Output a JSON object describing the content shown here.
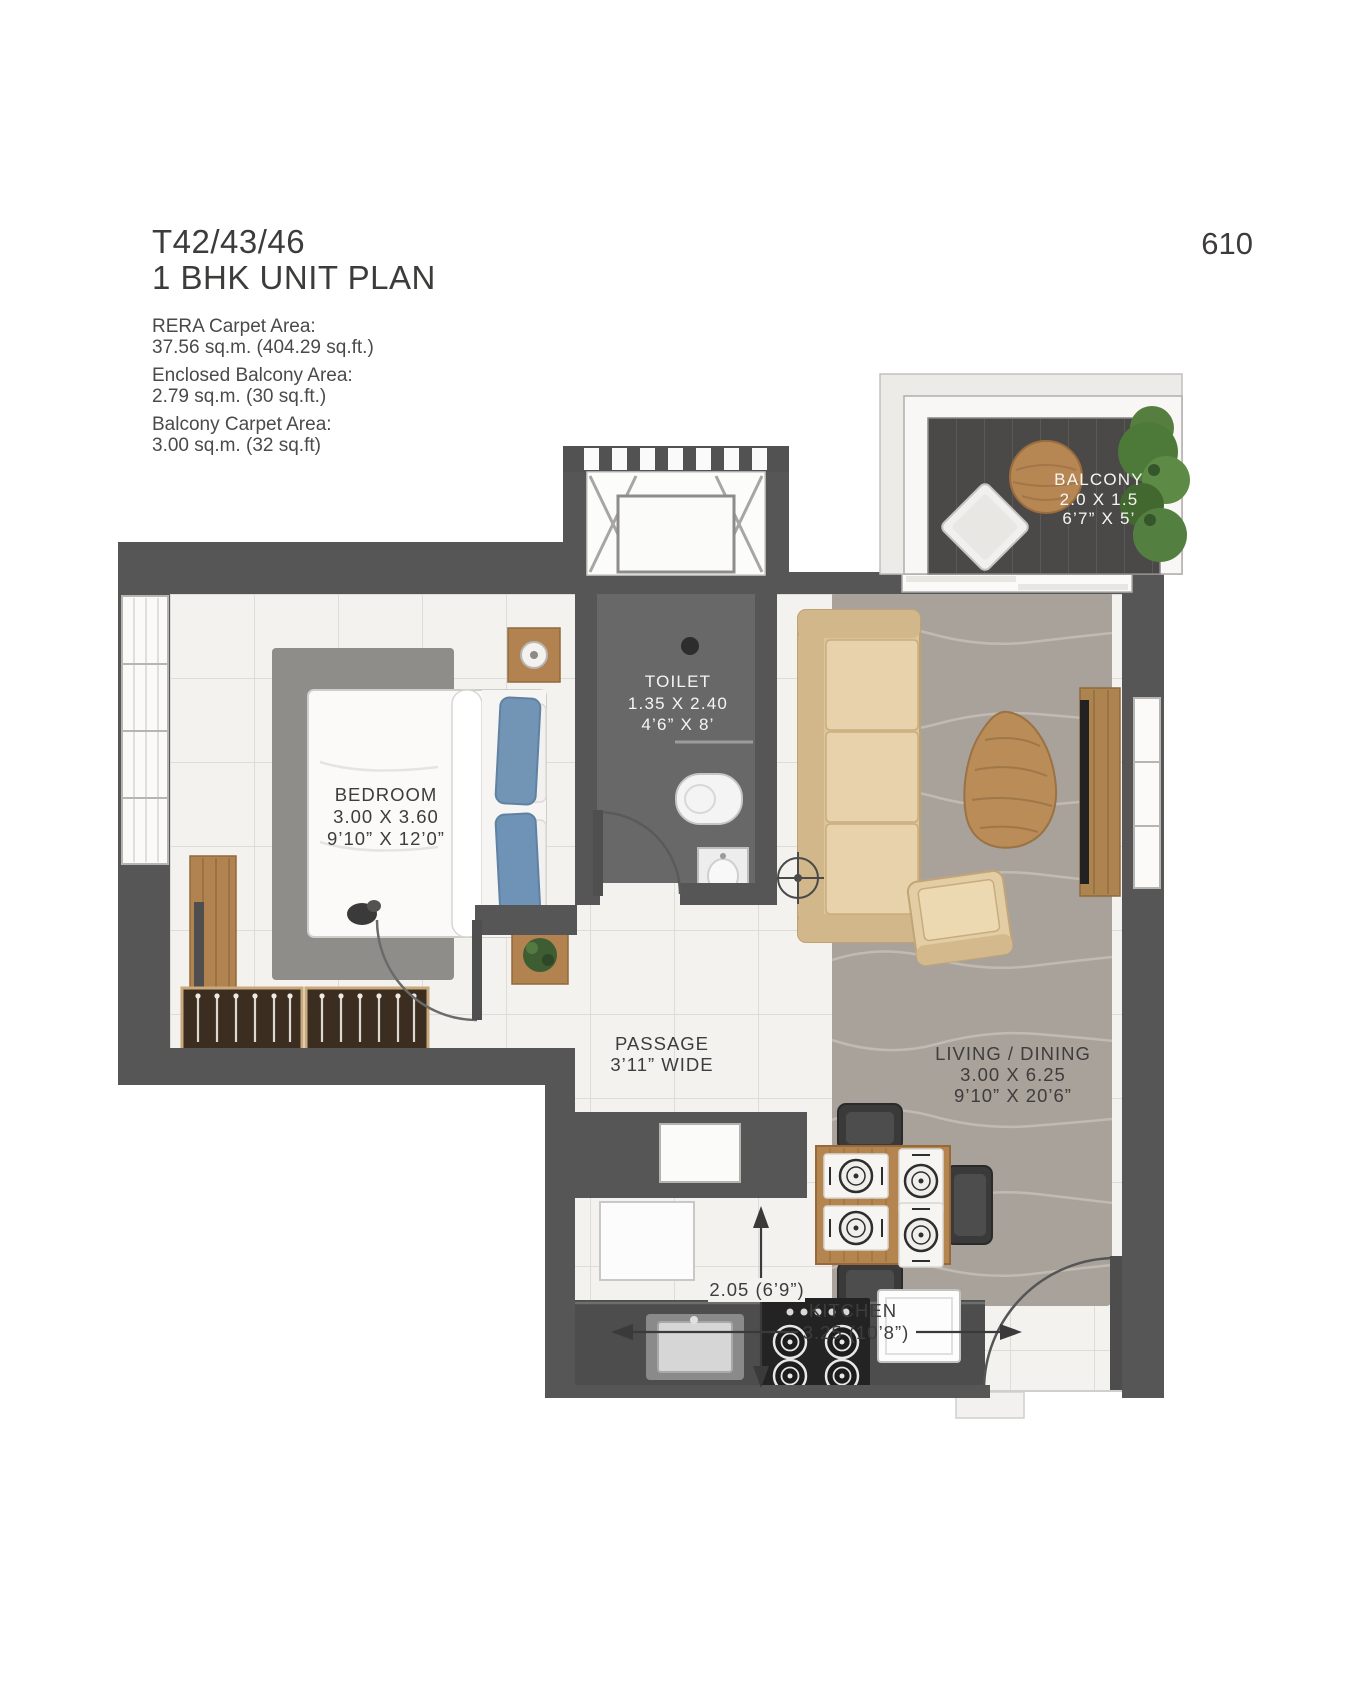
{
  "header": {
    "unit_code": "T42/43/46",
    "plan_title": "1 BHK UNIT PLAN",
    "page_number": "610"
  },
  "area_details": [
    {
      "label": "RERA Carpet Area:",
      "value": "37.56 sq.m. (404.29 sq.ft.)"
    },
    {
      "label": "Enclosed Balcony Area:",
      "value": "2.79 sq.m. (30 sq.ft.)"
    },
    {
      "label": "Balcony Carpet Area:",
      "value": "3.00 sq.m. (32 sq.ft)"
    }
  ],
  "rooms": {
    "balcony": {
      "name": "BALCONY",
      "dim_m": "2.0 X 1.5",
      "dim_ft": "6’7” X 5’"
    },
    "toilet": {
      "name": "TOILET",
      "dim_m": "1.35 X 2.40",
      "dim_ft": "4’6” X 8’"
    },
    "bedroom": {
      "name": "BEDROOM",
      "dim_m": "3.00 X 3.60",
      "dim_ft": "9’10” X 12’0”"
    },
    "living_dining": {
      "name": "LIVING / DINING",
      "dim_m": "3.00 X 6.25",
      "dim_ft": "9’10” X 20’6”"
    },
    "passage": {
      "name": "PASSAGE",
      "width": "3’11” WIDE"
    },
    "kitchen": {
      "name": "KITCHEN",
      "width_dim": "3.25 (10’8”)",
      "depth_dim": "2.05 (6’9”)"
    }
  },
  "colors": {
    "wall": "#565656",
    "tile_floor": "#f3f2ef",
    "toilet_floor": "#686868",
    "balcony_deck": "#4b4948",
    "wood": "#b28350",
    "upholstery_beige": "#e3cda4",
    "pillow_blue": "#7294b5",
    "annotation": "#3e3d3c"
  }
}
